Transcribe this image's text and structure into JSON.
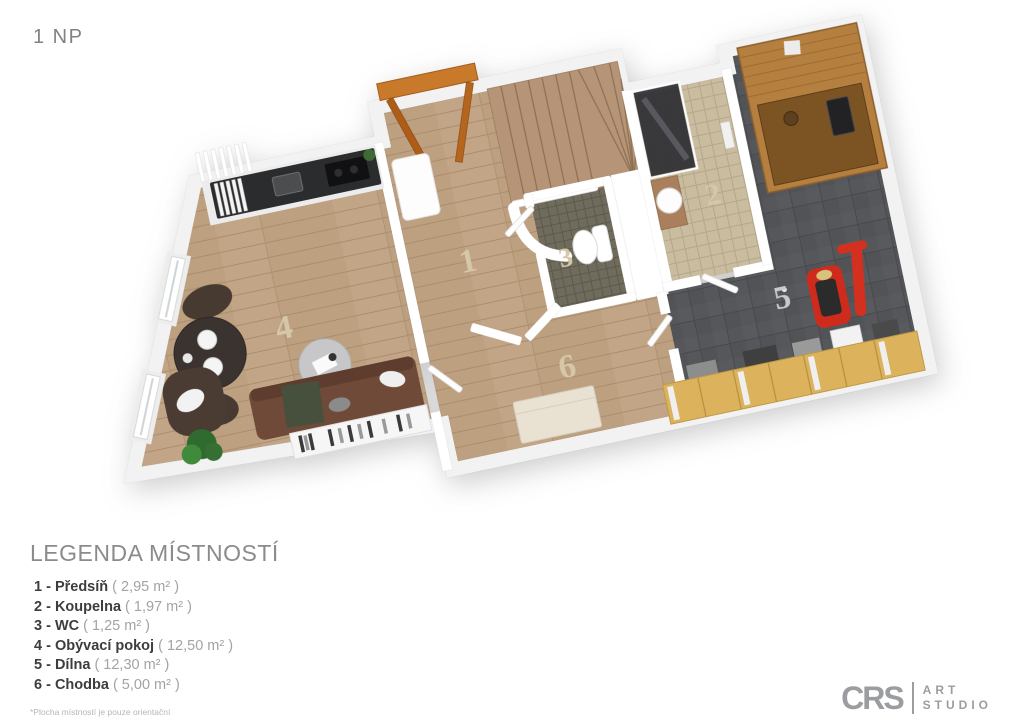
{
  "header": {
    "title": "1 NP"
  },
  "plan": {
    "rooms": [
      {
        "number": "1",
        "name": "Předsíň"
      },
      {
        "number": "2",
        "name": "Koupelna"
      },
      {
        "number": "3",
        "name": "WC"
      },
      {
        "number": "4",
        "name": "Obývací pokoj"
      },
      {
        "number": "5",
        "name": "Dílna"
      },
      {
        "number": "6",
        "name": "Chodba"
      }
    ]
  },
  "legend": {
    "title": "LEGENDA MÍSTNOSTÍ",
    "items": [
      {
        "label": "1 - Předsíň",
        "area": "( 2,95 m² )"
      },
      {
        "label": "2 - Koupelna",
        "area": "( 1,97 m² )"
      },
      {
        "label": "3 - WC",
        "area": "( 1,25 m² )"
      },
      {
        "label": "4 - Obývací pokoj",
        "area": "( 12,50 m² )"
      },
      {
        "label": "5 - Dílna",
        "area": "( 12,30 m² )"
      },
      {
        "label": "6 - Chodba",
        "area": "( 5,00 m² )"
      }
    ],
    "footnote": "*Plocha místností je pouze orientační"
  },
  "logo": {
    "brand": "CRS",
    "line1": "ART",
    "line2": "STUDIO"
  },
  "colors": {
    "wood_floor": "#c2a587",
    "dark_tile": "#56575b",
    "beige_tile": "#c9bc9f",
    "olive_tile": "#6f6c5d",
    "door_orange": "#c8792a",
    "tool_red": "#cf2b1c",
    "bench_yellow": "#dcb25c"
  }
}
